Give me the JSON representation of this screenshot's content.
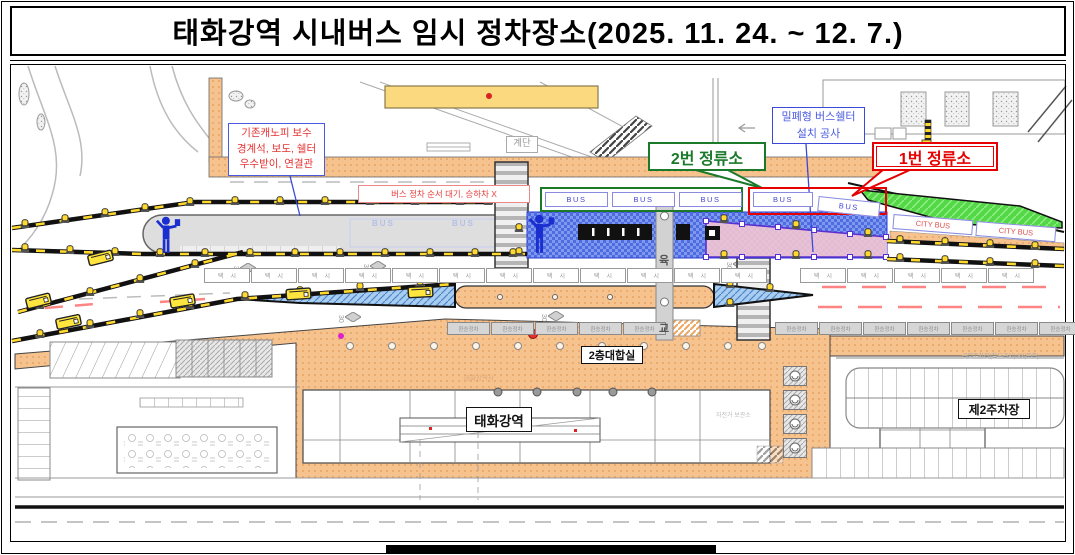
{
  "title": "태화강역 시내버스 임시 정차장소(2025. 11. 24. ~ 12. 7.)",
  "callouts": {
    "canopy_repair": {
      "line1": "기존캐노피 보수",
      "line2": "경계석, 보도, 쉘터",
      "line3": "우수받이, 연결관"
    },
    "shelter_construction": {
      "line1": "밀폐형 버스쉘터",
      "line2": "설치 공사"
    },
    "stop_no2": "2번 정류소",
    "stop_no1": "1번 정류소",
    "bus_wait_note": "버스 정차 순서 대기, 승하차 X"
  },
  "map_labels": {
    "stairs": "계단",
    "bus": "BUS",
    "city_bus": "CITY BUS",
    "overpass_char1": "육",
    "overpass_char2": "교",
    "taxi": "택시",
    "transfer_stop": "환승정차",
    "speed_30": "30",
    "waiting_room_2f": "2층대합실",
    "station_name": "태화강역",
    "station_building": "태화강역사",
    "bike_storage": "자전거 보관소",
    "parking_lot_no2": "제2주차장",
    "public_parking_note": "공영주차장(철도공사) 83(북측)"
  },
  "colors": {
    "title_text": "#000000",
    "callout_red": "#e63333",
    "callout_blue": "#3b49d8",
    "stop1_red": "#e60000",
    "stop2_green": "#1a7a2a",
    "bus_text_blue": "#4646d8",
    "city_bus_red": "#e05050",
    "construction_blue": "#4d6ce0",
    "closed_zone_pink": "#f7c6d2",
    "closed_zone_purple": "#5a2fd0",
    "grass_green": "#55d848",
    "plaza_orange": "#f6c28e",
    "barrier_yellow": "#ffd92e",
    "barrier_black": "#111111"
  },
  "icons": {
    "worker": "traffic-controller-icon",
    "lamp": "barrier-lamp-icon",
    "bus": "bus-vehicle-icon",
    "diamond": "road-diamond-marking-icon",
    "rack": "bicycle-rack-icon"
  }
}
